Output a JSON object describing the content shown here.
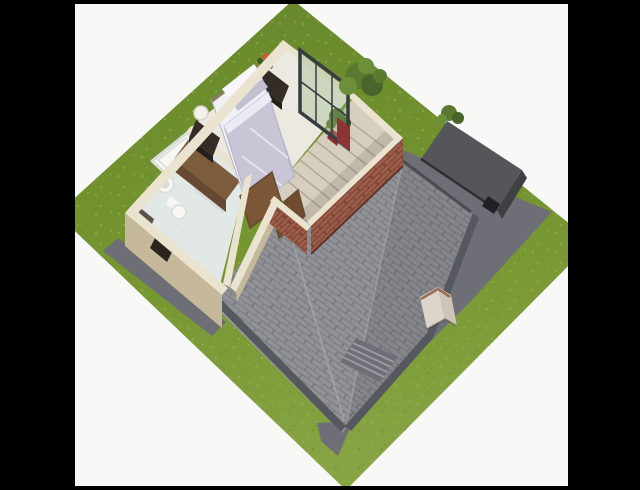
{
  "scene": {
    "image_type": "3d-dollhouse-floor-plan-render",
    "view": "aerial-isometric",
    "rooms": [
      {
        "name": "bedroom",
        "objects": [
          "double-bed",
          "white-pillows",
          "gray-pillows",
          "lavender-duvet",
          "nightstand-with-lamp",
          "dark-chest-with-flowers",
          "wood-wardrobe",
          "corner-plant",
          "glass-door-panel",
          "red-drape"
        ]
      },
      {
        "name": "bathroom",
        "objects": [
          "bathtub",
          "vanity-sink",
          "toilet",
          "laundry-hamper",
          "tall-cabinet"
        ]
      },
      {
        "name": "stairwell",
        "objects": [
          "staircase",
          "open-wood-doors",
          "brick-enclosure-walls"
        ]
      }
    ],
    "exterior": [
      "lawn",
      "driveway-apron",
      "main-shingle-roof",
      "roof-ridge",
      "chimney",
      "flat-roof-garage",
      "patio",
      "exterior-steps",
      "large-bush",
      "small-bush"
    ],
    "framing": [
      "black-letterbox-left",
      "black-letterbox-right",
      "thin-black-top-bar",
      "thin-black-bottom-bar",
      "white-backdrop"
    ]
  },
  "colors": {
    "background": "#f8f8f7",
    "letterbox": "#000000",
    "grass_dark": "#67882c",
    "grass_mid": "#74942f",
    "grass_light": "#86a443",
    "grass_speckle": "#97b258",
    "apron": "#6e6f76",
    "apron_light": "#989aa0",
    "roof_base": "#909297",
    "roof_line": "#7a7c81",
    "roof_eave": "#56585f",
    "roof_gutter": "#4b4d53",
    "ridge_light": "#a8abaf",
    "garage_top": "#54565a",
    "garage_face": "#3e4044",
    "garage_edge": "#2c2e31",
    "garage_door": "#1f2124",
    "wall_cap": "#eae3d0",
    "wall_tan": "#c6b99b",
    "wall_inner": "#f3edde",
    "brick": "#9b5c49",
    "brick_line": "#7c4335",
    "brick_shadow": "#5f3328",
    "floor_bedroom": "#ece9e1",
    "floor_bathroom": "#e2e8e5",
    "stair_fill": "#d6cfbe",
    "stair_line": "#b2aa97",
    "wood_top": "#7d5c3d",
    "wood_face": "#654930",
    "door_wood": "#7b5738",
    "door_wood_dark": "#6f4c2f",
    "door_gap": "#2a251f",
    "dark_furniture": "#342d27",
    "dark_furniture_face": "#241f1a",
    "bed_base": "#f1f0f4",
    "headboard": "#8a7a68",
    "duvet": "#c8c5d6",
    "duvet_edge": "#b4b1c6",
    "duvet_fold": "#eceaf2",
    "pillow_white": "#f7f6f9",
    "pillow_gray": "#c2bfcf",
    "fixture_white": "#f7f7f4",
    "fixture_shadow": "#d9dcd8",
    "cabinet_top": "#5a5148",
    "cabinet_face": "#443c33",
    "plant_green": "#4a682a",
    "plant_green_dark": "#3c591f",
    "plant_green_light": "#567632",
    "flower_orange": "#c2622e",
    "pot_red": "#8c2d2d",
    "drape_red": "#8e3434",
    "frame_dark": "#383c40",
    "glass_tint": "rgba(150,180,130,0.35)",
    "chimney_light": "#ddd5c9",
    "chimney_dark": "#cec5b7",
    "chimney_trim": "#9c6a50",
    "bush_green": "#5a7a30",
    "bush_green_dark": "#49652a",
    "bush_green_light": "#6b8f3a"
  }
}
